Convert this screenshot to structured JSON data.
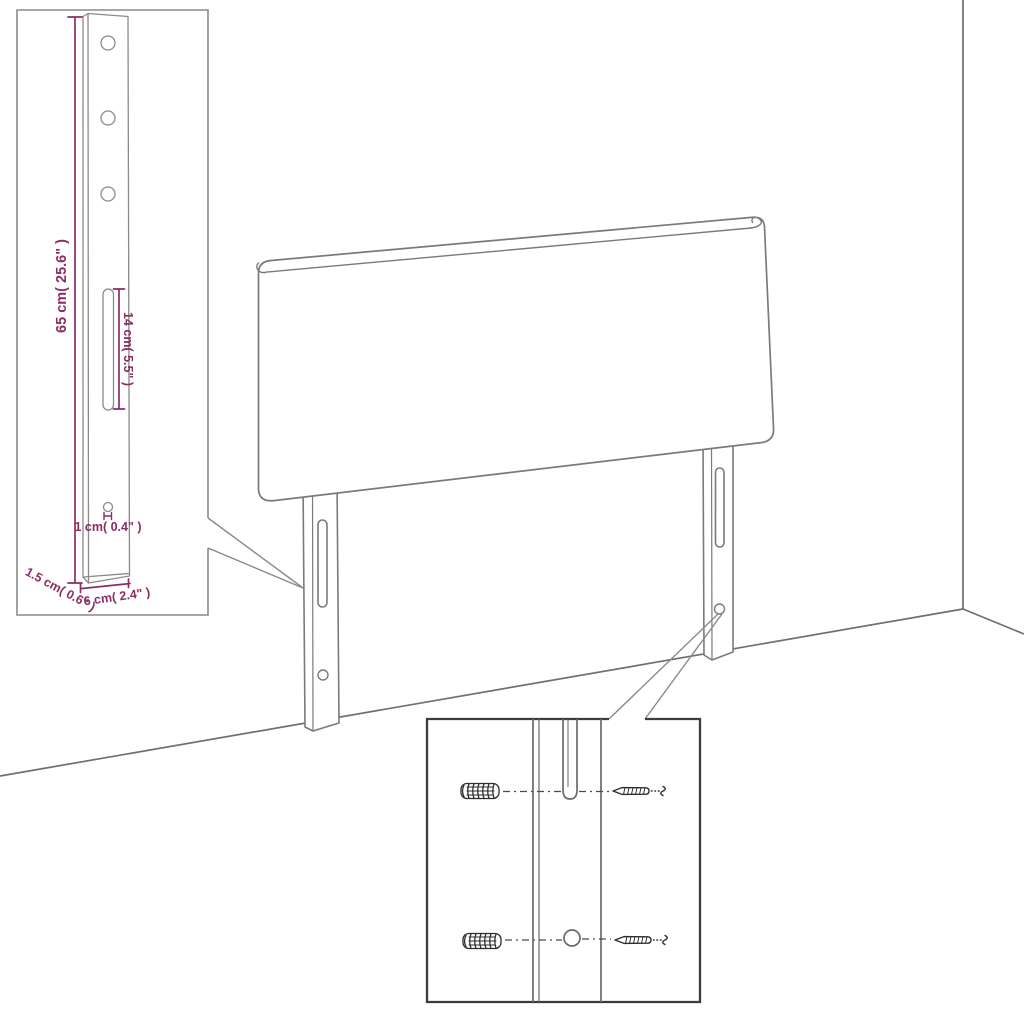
{
  "diagram_type": "headboard-assembly-dimension-diagram",
  "colors": {
    "annotation": "#8a2e66",
    "outline": "#7a7a7a",
    "inset_outline": "#8a8a8a",
    "detail_box": "#3c3c3c",
    "hardware": "#2e2e2e",
    "background": "#ffffff"
  },
  "labels": {
    "leg_height": "65 cm( 25.6\" )",
    "slot_length": "14 cm( 5.5\" )",
    "hole_diameter": "1 cm( 0.4\" )",
    "base_depth": "1.5 cm( 0.6\" )",
    "base_width": "6 cm( 2.4\" )"
  }
}
